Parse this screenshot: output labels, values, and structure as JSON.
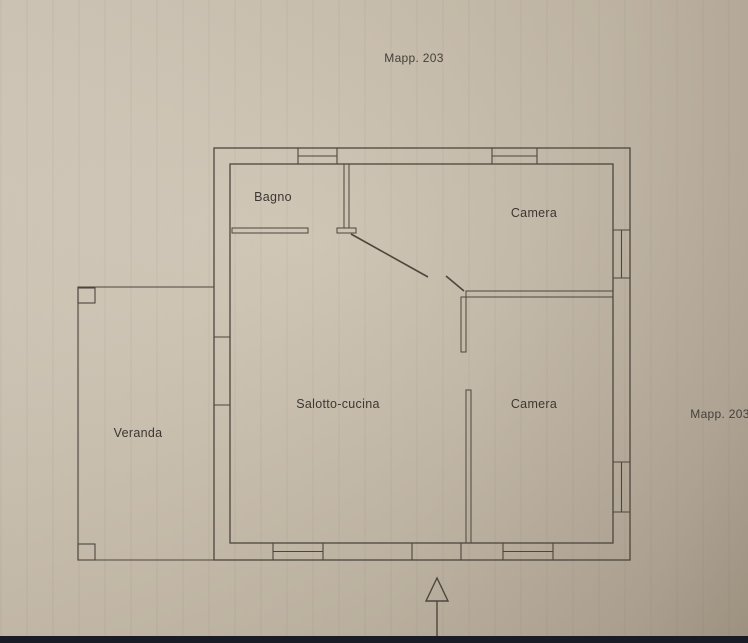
{
  "photo": {
    "paper_color": "#c8bdab",
    "ink_color": "#4d463c",
    "bottom_bar_color": "#1a1c25"
  },
  "plan": {
    "map_label_top": "Mapp. 203",
    "map_label_right": "Mapp. 203",
    "rooms": [
      {
        "name": "bagno",
        "label": "Bagno"
      },
      {
        "name": "camera-top",
        "label": "Camera"
      },
      {
        "name": "camera-bottom",
        "label": "Camera"
      },
      {
        "name": "salotto-cucina",
        "label": "Salotto-cucina"
      },
      {
        "name": "veranda",
        "label": "Veranda"
      }
    ]
  }
}
